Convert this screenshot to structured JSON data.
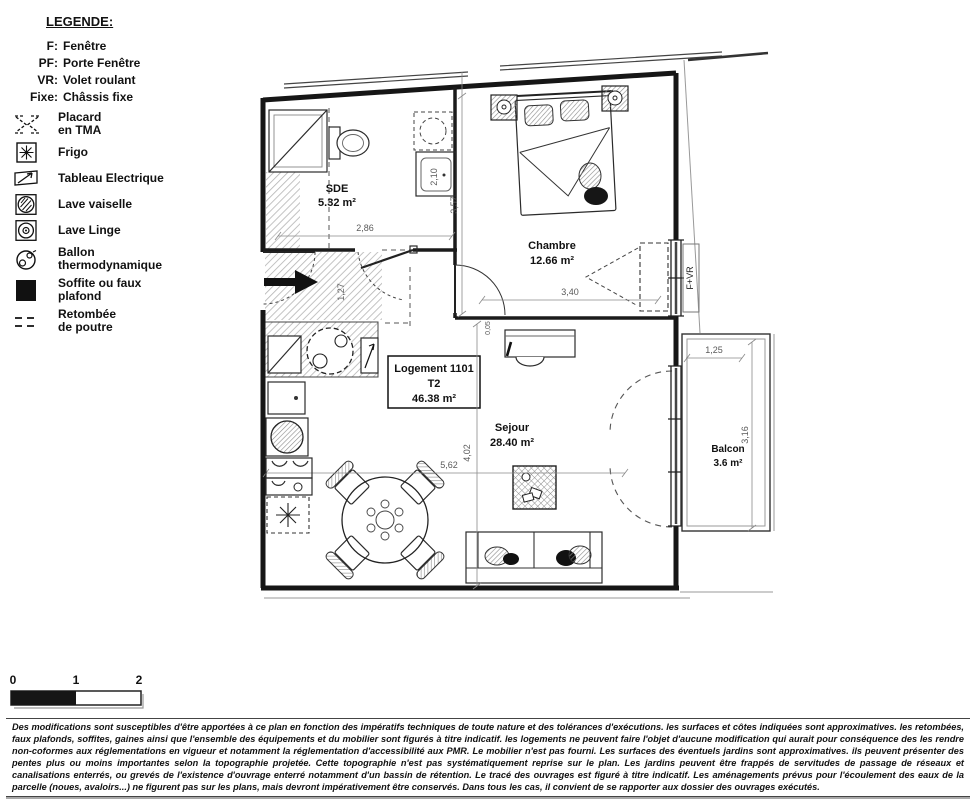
{
  "legend": {
    "title": "LEGENDE:",
    "abbrev": [
      {
        "key": "F:",
        "label": "Fenêtre"
      },
      {
        "key": "PF:",
        "label": "Porte Fenêtre"
      },
      {
        "key": "VR:",
        "label": "Volet roulant"
      },
      {
        "key": "Fixe:",
        "label": "Châssis fixe"
      }
    ],
    "items": [
      {
        "name": "placard",
        "label1": "Placard",
        "label2": "en TMA"
      },
      {
        "name": "frigo",
        "label1": "Frigo",
        "label2": ""
      },
      {
        "name": "tableau",
        "label1": "Tableau Electrique",
        "label2": ""
      },
      {
        "name": "lave-vaiselle",
        "label1": "Lave vaiselle",
        "label2": ""
      },
      {
        "name": "lave-linge",
        "label1": "Lave Linge",
        "label2": ""
      },
      {
        "name": "ballon",
        "label1": "Ballon",
        "label2": "thermodynamique"
      },
      {
        "name": "soffite",
        "label1": "Soffite ou faux",
        "label2": "plafond"
      },
      {
        "name": "retombee",
        "label1": "Retombée",
        "label2": "de poutre"
      }
    ]
  },
  "plan": {
    "unit_box": {
      "line1": "Logement 1101",
      "line2": "T2",
      "line3": "46.38 m²"
    },
    "rooms": {
      "sde": {
        "name": "SDE",
        "area": "5.32 m²"
      },
      "chambre": {
        "name": "Chambre",
        "area": "12.66 m²"
      },
      "sejour": {
        "name": "Sejour",
        "area": "28.40 m²"
      },
      "balcon": {
        "name": "Balcon",
        "area": "3.6 m²"
      }
    },
    "windows": {
      "chambre": "F+VR",
      "sejour": "PF+Fixe+VR"
    },
    "dims": {
      "sde_w": "2,86",
      "sde_h": "2,10",
      "left_h": "3,57",
      "chambre_w": "3,40",
      "offset": "0,05",
      "hall_h": "1,27",
      "sejour_w": "5,62",
      "sejour_h": "4,02",
      "balcon_w": "1,25",
      "balcon_h": "3,16"
    }
  },
  "scale_bar": {
    "t0": "0",
    "t1": "1",
    "t2": "2"
  },
  "disclaimer": "Des modifications sont susceptibles d'être apportées à ce plan en fonction des impératifs techniques de toute nature et des tolérances d'exécutions. les surfaces et côtes indiquées sont approximatives. les retombées, faux plafonds, soffites, gaines ainsi que l'ensemble des équipements et du mobilier sont figurés à titre indicatif. les logements ne peuvent faire l'objet d'aucune modification qui aurait pour conséquence des les rendre non-coformes aux réglementations en vigueur et notamment la réglementation d'accessibilité aux PMR. Le mobilier n'est pas fourni. Les surfaces des éventuels jardins sont approximatives. ils peuvent présenter des pentes plus ou moins importantes selon la topographie projetée. Cette topographie n'est pas systématiquement reprise sur le plan. Les jardins peuvent être frappés de servitudes de passage de réseaux et canalisations enterrés, ou grevés de l'existence d'ouvrage enterré notamment d'un bassin de rétention. Le tracé des ouvrages est figuré à titre indicatif. Les aménagements prévus pour l'écoulement des eaux de la parcelle (noues, avaloirs...) ne figurent pas sur les plans, mais devront impérativement être conservés. Dans tous les cas, il convient de se rapporter aux dossier des ouvrages exécutés."
}
